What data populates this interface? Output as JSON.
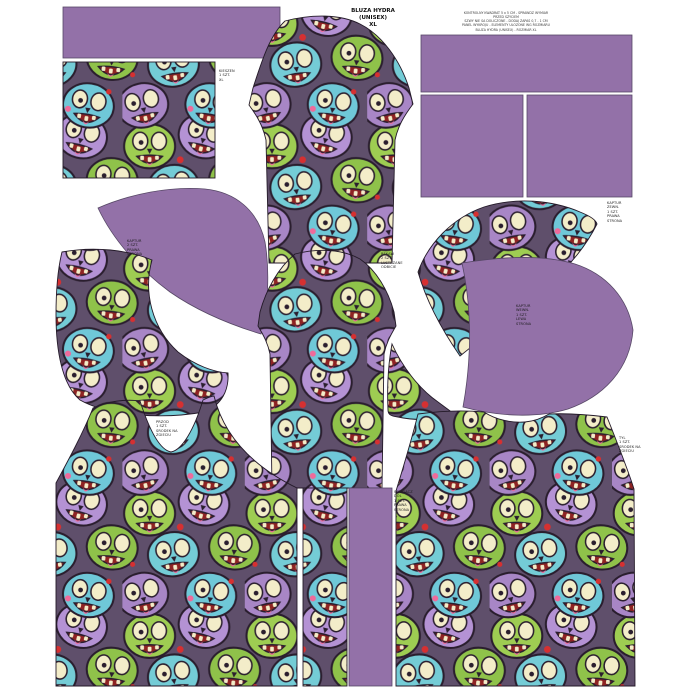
{
  "colors": {
    "purple": "#9371a8",
    "purple_outline": "#574866",
    "piece_outline": "#241a29",
    "print_background": "#5f4f6b",
    "print_green": "#9ecd52",
    "print_green_dark": "#8fc24a",
    "print_teal": "#74ccd6",
    "print_teal_dark": "#6fc8d8",
    "print_purple": "#b492d4",
    "print_purple_dark": "#a886c6",
    "print_bone": "#f3edc9",
    "print_mouth_red": "#8e2323",
    "print_splat_red": "#d63031",
    "print_pink": "#ef6a9a"
  },
  "header": {
    "title": "BLUZA HYDRA\n(UNISEX)\nXL",
    "instructions": "KONTROLNY KWADRAT 5 x 5 CM - SPRAWDZ WYMIAR PRZED SZYCIEM\nSZWY NIE SA DOLICZONE - DODAJ ZAPAS 0,7 - 1 CM\nPANEL WYKROJU - ELEMENTY ULOZONE WG ROZMIARU\nBLUZA HYDRA (UNISEX) - ROZMIAR XL"
  },
  "piece_labels": {
    "pocket_panel": "KIESZEN\n1 SZT.\nXL",
    "hood_front_print": "KAPTUR\n2 SZT.\nPRAWA\nSTRONA",
    "sleeves": "REKAW\n2 SZT.\nLUSTRZANE\nODBICIE",
    "hood_outer": "KAPTUR\nZEWN.\n1 SZT.\nPRAWA\nSTRONA",
    "hood_inner": "KAPTUR\nWEWN.\n1 SZT.\nLEWA\nSTRONA",
    "front_bodice": "PRZOD\n1 SZT.\nSRODEK NA\nZGIECIU",
    "ribbing_strip": "SCIAGACZ\nDOL\n1 SZT.\nPRAWA\nSTRONA",
    "back_bodice": "TYL\n1 SZT.\nSRODEK NA\nZGIECIU"
  }
}
